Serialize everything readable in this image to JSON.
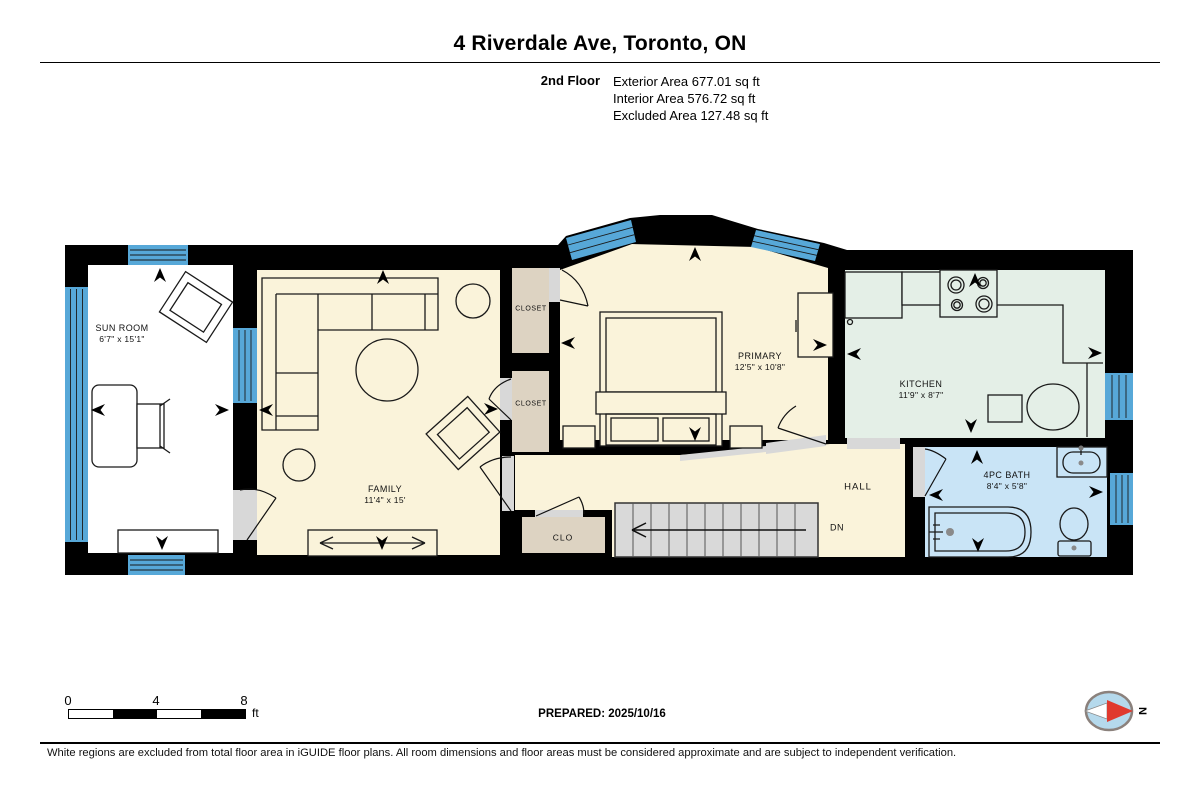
{
  "header": {
    "title": "4 Riverdale Ave, Toronto, ON",
    "floor_label": "2nd Floor",
    "area_lines": [
      "Exterior Area 677.01 sq ft",
      "Interior Area 576.72 sq ft",
      "Excluded Area 127.48 sq ft"
    ]
  },
  "rooms": {
    "sun_room": {
      "label": "SUN ROOM",
      "dims": "6'7\" x 15'1\""
    },
    "family": {
      "label": "FAMILY",
      "dims": "11'4\" x 15'"
    },
    "primary": {
      "label": "PRIMARY",
      "dims": "12'5\" x 10'8\""
    },
    "kitchen": {
      "label": "KITCHEN",
      "dims": "11'9\" x 8'7\""
    },
    "bath": {
      "label": "4PC BATH",
      "dims": "8'4\" x 5'8\""
    },
    "hall": {
      "label": "HALL"
    },
    "closet_upper": {
      "label": "CLOSET"
    },
    "closet_lower": {
      "label": "CLOSET"
    },
    "clo": {
      "label": "CLO"
    },
    "stairs": {
      "label": "DN"
    }
  },
  "footer": {
    "scale": {
      "tick0": "0",
      "tick4": "4",
      "tick8": "8",
      "unit": "ft"
    },
    "prepared": "PREPARED: 2025/10/16",
    "compass_label": "N",
    "disclaimer": "White regions are excluded from total floor area in iGUIDE floor plans. All room dimensions and floor areas must be considered approximate and are subject to independent verification."
  },
  "colors": {
    "wall": "#000000",
    "room_cream": "#faf3da",
    "kitchen_mint": "#e4efe7",
    "bath_blue": "#c9e4f6",
    "closet_beige": "#ddd3c2",
    "stairs_gray": "#d9d9d9",
    "door_gray": "#d8d8d8",
    "window_blue": "#57a8d8",
    "excluded_white": "#ffffff",
    "compass_red": "#e0392e",
    "compass_blue": "#b5d9ec"
  }
}
